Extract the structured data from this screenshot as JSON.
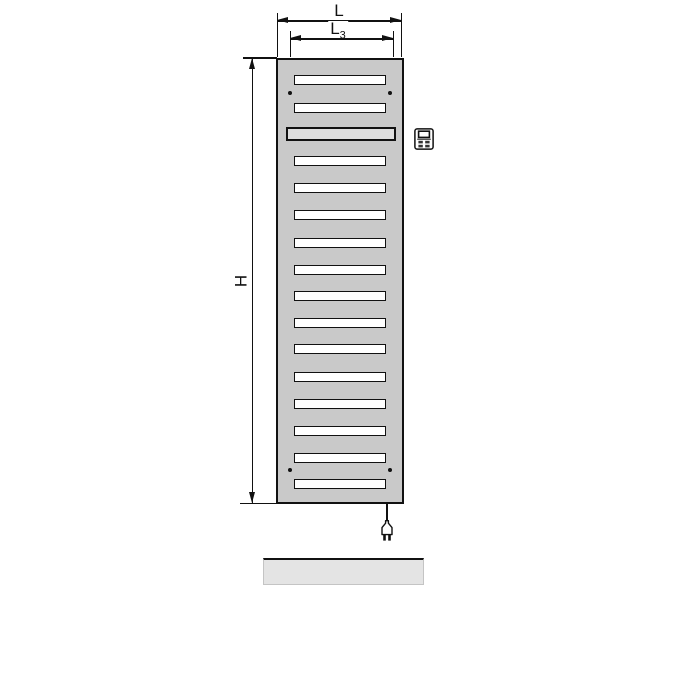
{
  "page": {
    "background": "#ffffff",
    "width": 700,
    "height": 700
  },
  "dimensions": {
    "width_label": "L",
    "inner_width_label_main": "L",
    "inner_width_label_sub": "3",
    "height_label": "H"
  },
  "radiator": {
    "body_color": "#c9c9c9",
    "outline_color": "#111111",
    "slat_fill": "#ffffff",
    "heater_bar_fill": "#dedede",
    "slats": [
      {
        "y": 75,
        "type": "slot"
      },
      {
        "y": 103,
        "type": "slot"
      },
      {
        "y": 127,
        "type": "heater"
      },
      {
        "y": 156,
        "type": "slot"
      },
      {
        "y": 183,
        "type": "slot"
      },
      {
        "y": 210,
        "type": "slot"
      },
      {
        "y": 238,
        "type": "slot"
      },
      {
        "y": 265,
        "type": "slot"
      },
      {
        "y": 291,
        "type": "slot"
      },
      {
        "y": 318,
        "type": "slot"
      },
      {
        "y": 344,
        "type": "slot"
      },
      {
        "y": 372,
        "type": "slot"
      },
      {
        "y": 399,
        "type": "slot"
      },
      {
        "y": 426,
        "type": "slot"
      },
      {
        "y": 453,
        "type": "slot"
      },
      {
        "y": 479,
        "type": "slot"
      }
    ],
    "mounting_dots": [
      {
        "x": 290,
        "y": 93
      },
      {
        "x": 390,
        "y": 93
      },
      {
        "x": 290,
        "y": 470
      },
      {
        "x": 390,
        "y": 470
      }
    ]
  },
  "accessories": {
    "control_unit_icon": "control-unit-icon",
    "power_plug_icon": "power-plug-icon"
  },
  "floor": {
    "color": "#e4e4e4",
    "edge_color": "#111111"
  }
}
